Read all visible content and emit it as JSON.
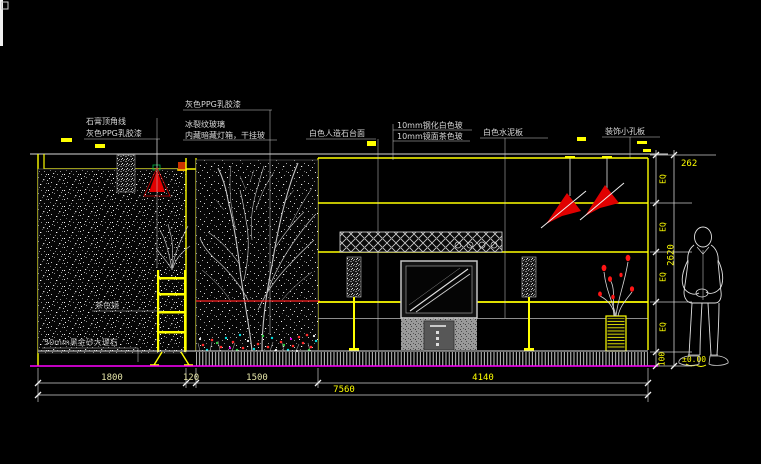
{
  "title": "室内立面图 CAD elevation",
  "annotations": {
    "gypsum_line": "石膏顶角线",
    "gray_ppg_left": "灰色PPG乳胶漆",
    "gray_ppg_top": "灰色PPG乳胶漆",
    "ice_crack_glass": "冰裂纹玻璃",
    "hidden_lightbox": "内藏暗藏灯箱，干挂玻",
    "white_artificial_stone": "白色人造石台面",
    "glass_white": "10mm钢化白色玻",
    "glass_tea": "10mm镜面茶色玻",
    "white_cement_board": "白色水泥板",
    "perforated_panel": "装饰小孔板",
    "tea_mirror": "茶色镜",
    "marble_counter": "50mm黑金砂大理石"
  },
  "dimensions": {
    "segments": [
      "1800",
      "120",
      "1500",
      "4140"
    ],
    "total": "7560",
    "right_top": "262",
    "eq": "EQ",
    "right_overall": "2620",
    "right_base": "100",
    "level": "±0.00"
  },
  "colors": {
    "background": "#000000",
    "line_yellow": "#ffff00",
    "floor_magenta": "#ff00ff",
    "accent_red": "#e00000",
    "drawing_white": "#e8e8e8"
  }
}
